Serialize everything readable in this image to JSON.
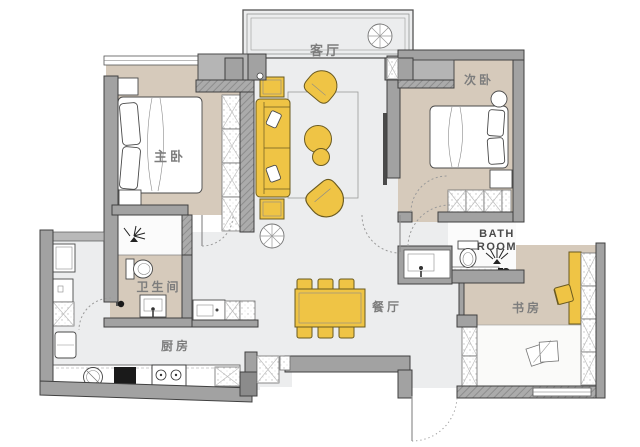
{
  "plan": {
    "rooms": {
      "living_room": "客厅",
      "master_bedroom": "主卧",
      "second_bedroom": "次卧",
      "bathroom_main": "卫生间",
      "bathroom_guest_line1": "BATH",
      "bathroom_guest_line2": "ROOM",
      "kitchen": "厨房",
      "dining_room": "餐厅",
      "study": "书房"
    },
    "colors": {
      "furniture_yellow": "#EFC445",
      "floor_beige": "#D6CABB",
      "floor_light": "#ECEDEE",
      "wall_gray": "#A2A2A2",
      "wall_dark": "#8B8B8B",
      "outline": "#404040",
      "label_gray": "#7D7D7D"
    }
  }
}
